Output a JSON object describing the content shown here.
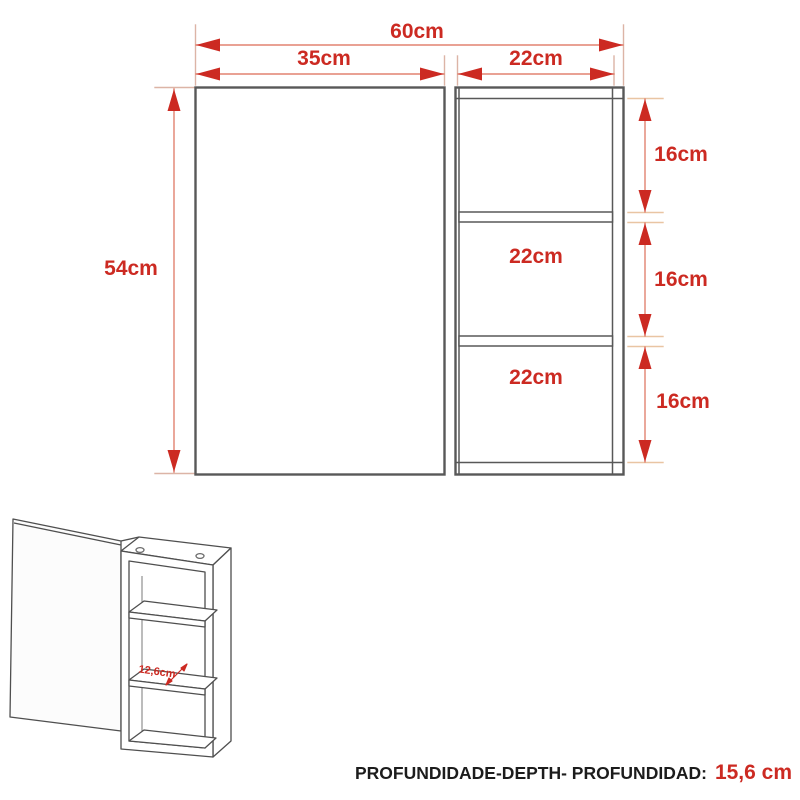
{
  "front_view": {
    "total_width_label": "60cm",
    "door_width_label": "35cm",
    "column_width_label": "22cm",
    "height_label": "54cm",
    "compartment_width_labels": [
      "22cm",
      "22cm"
    ],
    "compartment_height_labels": [
      "16cm",
      "16cm",
      "16cm"
    ]
  },
  "iso_view": {
    "shelf_depth_label": "12,6cm"
  },
  "footer": {
    "label": "PROFUNDIDADE-DEPTH- PROFUNDIDAD:",
    "value": "15,6 cm"
  },
  "colors": {
    "dimension_red": "#cc2a22",
    "dimension_line_light": "#e28270",
    "tick_light": "#e9c5a3",
    "extension_light": "#dcb4a6",
    "outline_dark": "#585858",
    "background": "#ffffff"
  }
}
